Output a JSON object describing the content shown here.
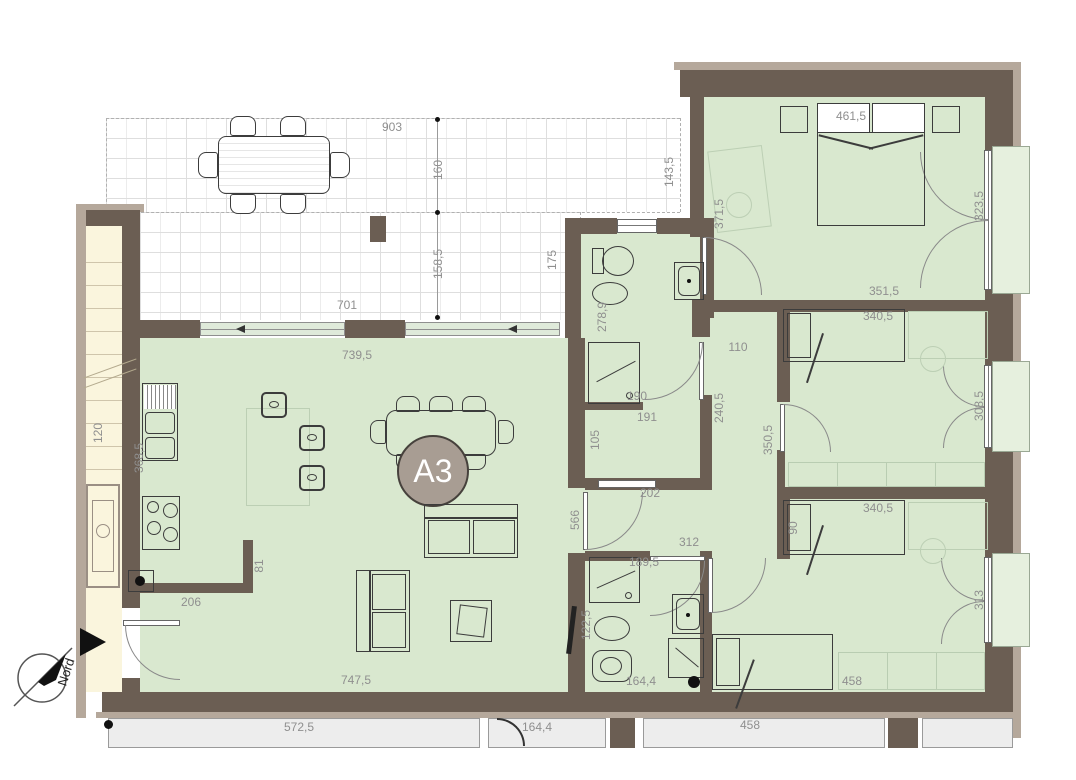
{
  "unit_label": "A3",
  "compass_label": "Nord",
  "dims": {
    "terrace_top": "903",
    "terrace_upper_depth": "160",
    "terrace_lower_depth": "158,5",
    "terrace_bottom": "701",
    "terrace_right_depth": "175",
    "terrace_right_edge": "143,5",
    "stair_width": "120",
    "living_top": "739,5",
    "living_bottom": "747,5",
    "living_height": "566",
    "kitchen_counter": "368,5",
    "kitchen_return": "81",
    "kitchen_front": "206",
    "bath1_depth": "278,9",
    "bath1_shower": "190",
    "closet_width": "191",
    "closet_depth": "105",
    "closet_passage": "202",
    "hall_width": "110",
    "hall_depth": "240,5",
    "corridor_depth": "350,5",
    "master_depth": "371,5",
    "master_width": "461,5",
    "master_window": "323,5",
    "bedroom2_width": "351,5",
    "bedroom2_bed": "340,5",
    "bedroom2_window": "308,5",
    "bedroom3_bed": "340,5",
    "bedroom3_bed_depth": "90",
    "bedroom3_window": "313",
    "bedroom3_bottom": "458",
    "hall2_width": "312",
    "bath2_shower": "189,5",
    "bath2_depth": "122,5",
    "bath2_bottom": "164,4",
    "below_unit_left": "572,5",
    "below_unit_mid": "164,4",
    "below_unit_right": "458"
  }
}
